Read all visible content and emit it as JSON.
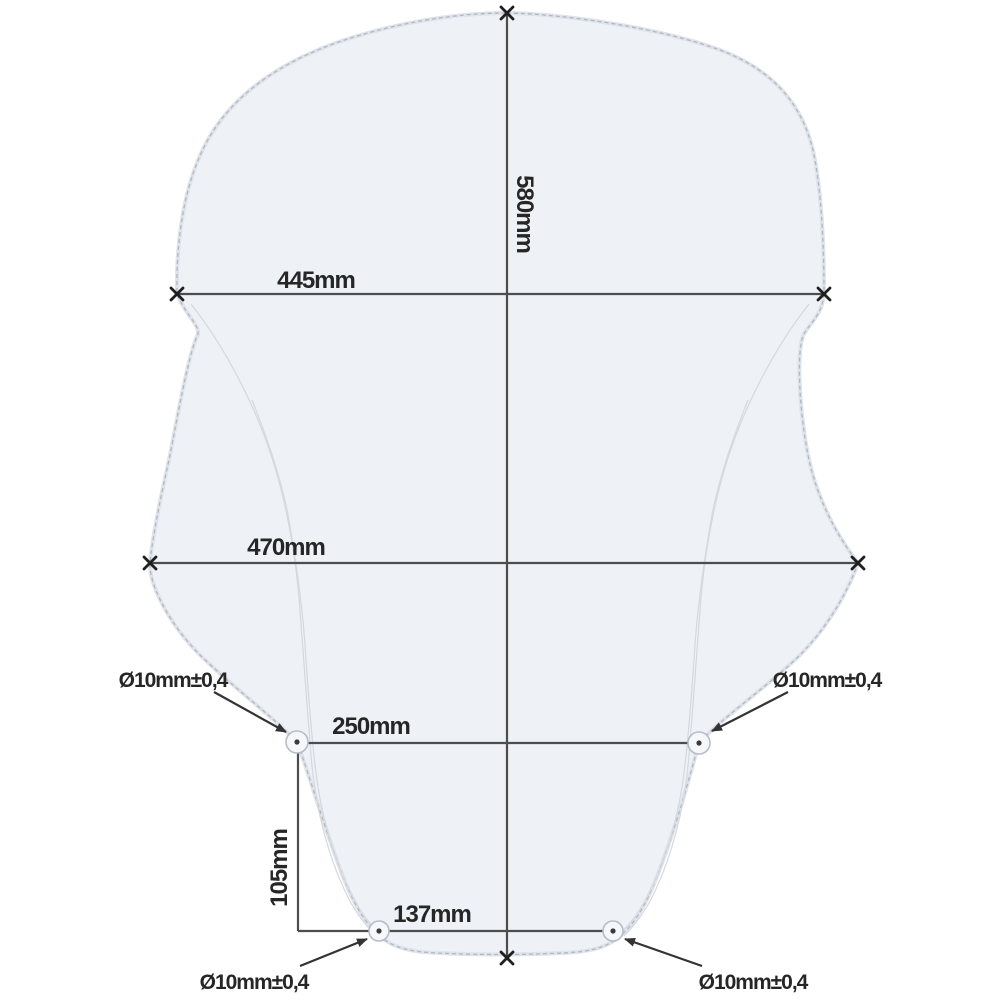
{
  "diagram": {
    "type": "technical-drawing-windscreen",
    "colors": {
      "shape_fill": "#eef1f6",
      "outline": "#b2b7c2",
      "dimension_lines": "#4d4d4d",
      "text": "#262626"
    },
    "dimensions": {
      "overall_height": "580mm",
      "top_width": "445mm",
      "middle_width": "470mm",
      "upper_hole_spacing": "250mm",
      "vertical_hole_offset": "105mm",
      "lower_hole_spacing": "137mm"
    },
    "hole_labels": {
      "top_left": "Ø10mm±0,4",
      "top_right": "Ø10mm±0,4",
      "bottom_left": "Ø10mm±0,4",
      "bottom_right": "Ø10mm±0,4"
    }
  }
}
